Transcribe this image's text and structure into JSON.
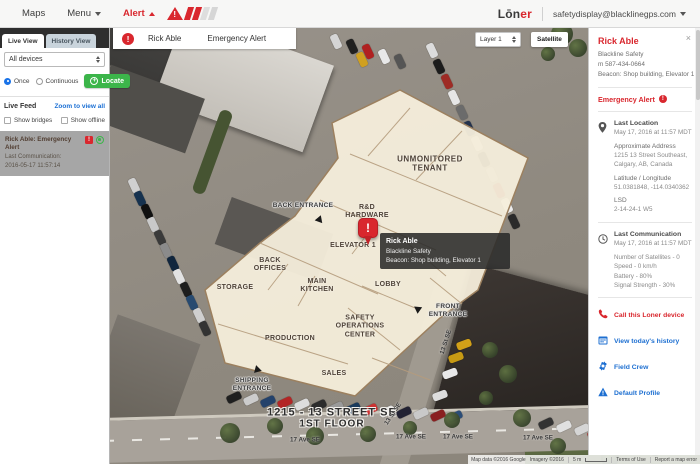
{
  "topbar": {
    "maps_label": "Maps",
    "menu_label": "Menu",
    "alert_label": "Alert",
    "logo_prefix": "Lōn",
    "logo_suffix": "er",
    "account_email": "safetydisplay@blacklinegps.com"
  },
  "left_panel": {
    "tab_live": "Live View",
    "tab_history": "History View",
    "device_filter": "All devices",
    "once_label": "Once",
    "continuous_label": "Continuous",
    "locate_label": "Locate",
    "live_feed_title": "Live Feed",
    "zoom_all_link": "Zoom to view all",
    "show_bridges_label": "Show bridges",
    "show_offline_label": "Show offline",
    "alert_item": {
      "badge": "!",
      "title": "Rick Able: Emergency Alert",
      "subtitle": "Last Communication:",
      "timestamp": "2016-05-17 11:57:14"
    }
  },
  "map": {
    "banner": {
      "excl": "!",
      "person": "Rick Able",
      "alert_type": "Emergency Alert"
    },
    "layer_select_value": "Layer 1",
    "map_type": {
      "map": "Map",
      "satellite": "Satellite"
    },
    "pin_excl": "!",
    "tooltip": {
      "name": "Rick Able",
      "org": "Blackline Safety",
      "beacon": "Beacon: Shop building, Elevator 1"
    },
    "rooms": [
      {
        "label": "UNMONITORED TENANT"
      },
      {
        "label": "R&D HARDWARE"
      },
      {
        "label": "ELEVATOR 1"
      },
      {
        "label": "LOBBY"
      },
      {
        "label": "BACK OFFICES"
      },
      {
        "label": "STORAGE"
      },
      {
        "label": "MAIN KITCHEN"
      },
      {
        "label": "SAFETY OPERATIONS CENTER"
      },
      {
        "label": "PRODUCTION"
      },
      {
        "label": "SALES"
      }
    ],
    "entrances": [
      {
        "label": "BACK ENTRANCE"
      },
      {
        "label": "SHIPPING ENTRANCE"
      },
      {
        "label": "FRONT ENTRANCE"
      }
    ],
    "address_line1": "1215 - 13 STREET SE",
    "address_line2": "1ST FLOOR",
    "street_ave": "17 Ave SE",
    "street_cross": "13 St SE",
    "attribution": {
      "map_data": "Map data ©2016 Google",
      "imagery": "Imagery ©2016",
      "scale": "5 m",
      "terms": "Terms of Use",
      "report": "Report a map error"
    }
  },
  "right_panel": {
    "close": "×",
    "name": "Rick Able",
    "org": "Blackline Safety",
    "phone": "m 587-434-0664",
    "beacon": "Beacon: Shop building, Elevator 1",
    "alert_status": "Emergency Alert",
    "last_location": {
      "title": "Last Location",
      "time": "May 17, 2016 at 11:57 MDT",
      "address_heading": "Approximate Address",
      "address_line1": "1215 13 Street Southeast,",
      "address_line2": "Calgary, AB, Canada",
      "latlng_heading": "Latitude / Longitude",
      "latlng": "51.0381848, -114.0340362",
      "lsd_heading": "LSD",
      "lsd": "2-14-24-1 W5"
    },
    "last_communication": {
      "title": "Last Communication",
      "time": "May 17, 2016 at 11:57 MDT",
      "satellites": "Number of Satellites - 0",
      "speed": "Speed - 0 km/h",
      "battery": "Battery - 80%",
      "signal": "Signal Strength - 30%"
    },
    "actions": {
      "call": "Call this Loner device",
      "history": "View today's history",
      "field_crew": "Field Crew",
      "default_profile": "Default Profile"
    }
  },
  "colors": {
    "accent_red": "#d9272e",
    "link_blue": "#1a6fd4",
    "locate_green": "#3cb54a"
  }
}
